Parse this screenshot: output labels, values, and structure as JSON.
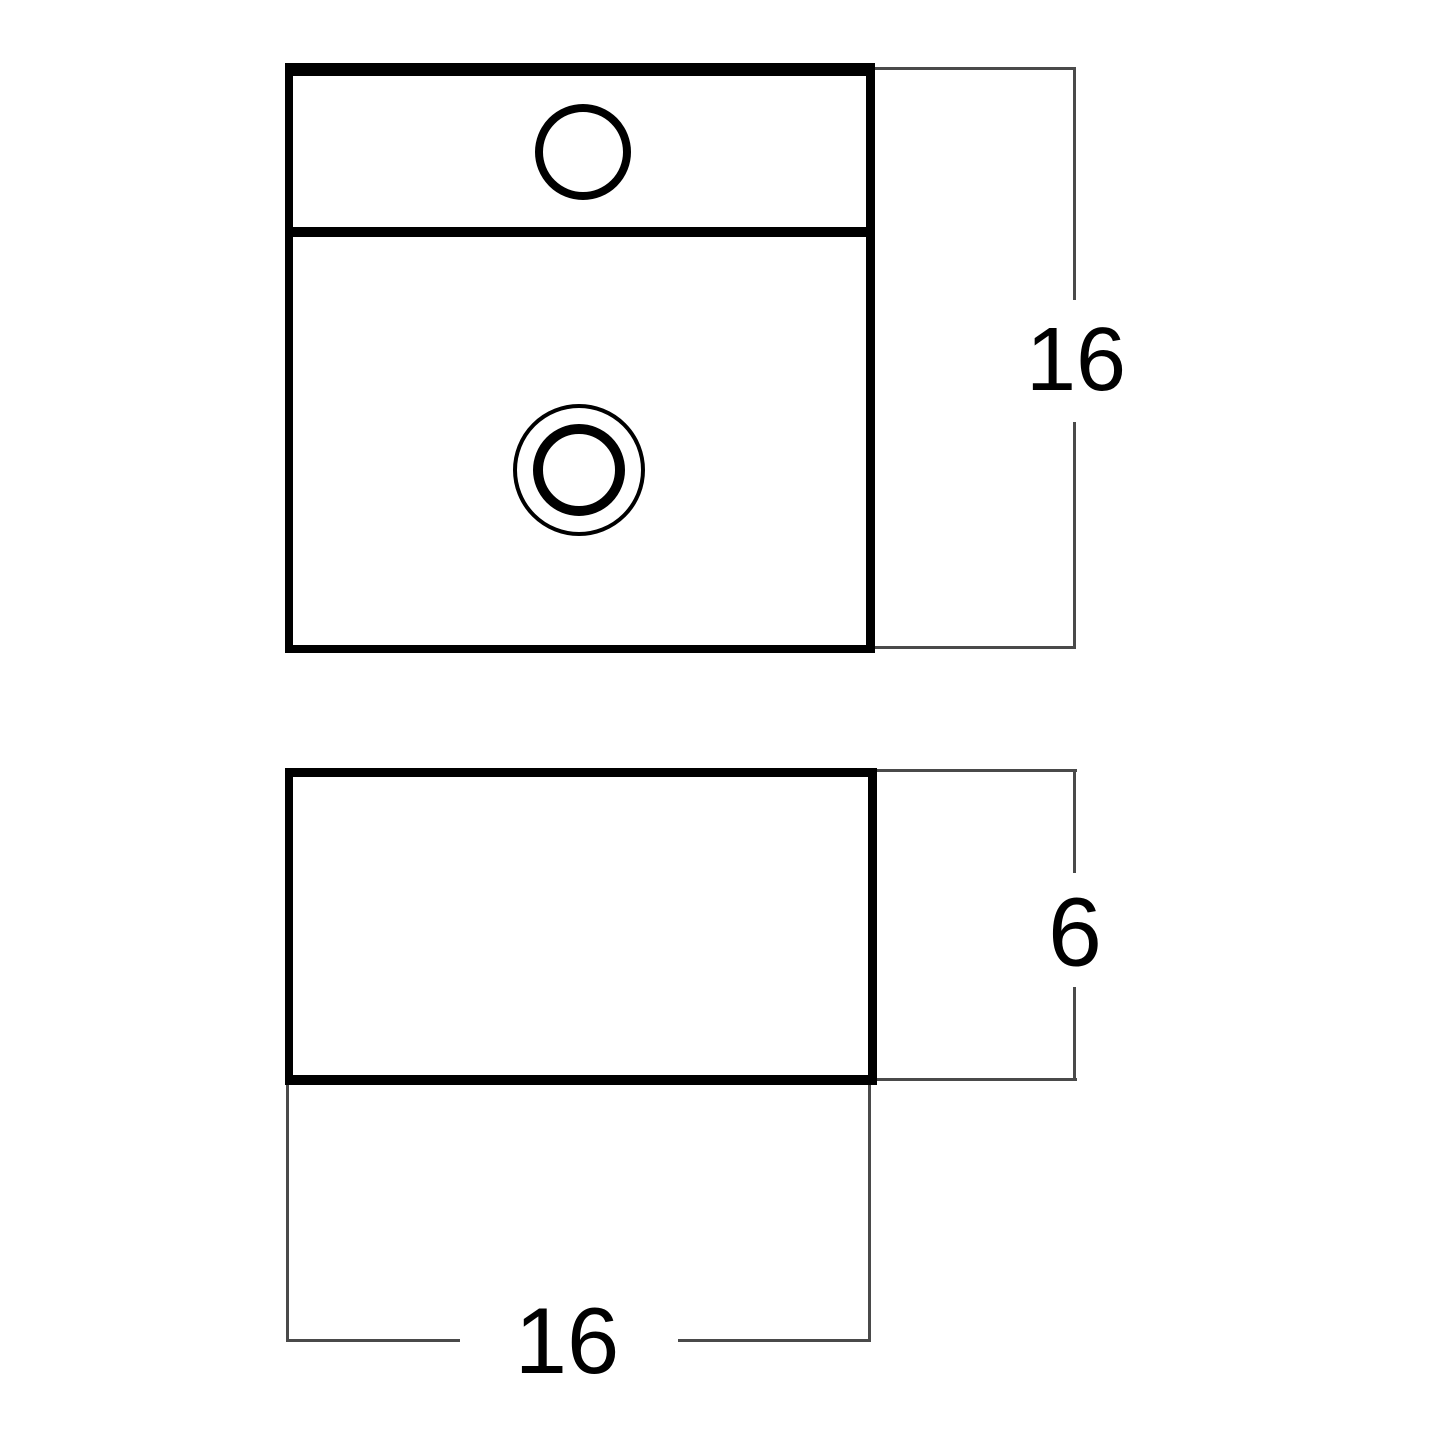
{
  "diagram": {
    "labels": {
      "plan_height": "16",
      "front_height": "6",
      "front_width": "16"
    },
    "colors": {
      "background": "#ffffff",
      "object_line": "#000000",
      "dimension_line": "#4a4a4a",
      "label_text": "#000000"
    }
  }
}
